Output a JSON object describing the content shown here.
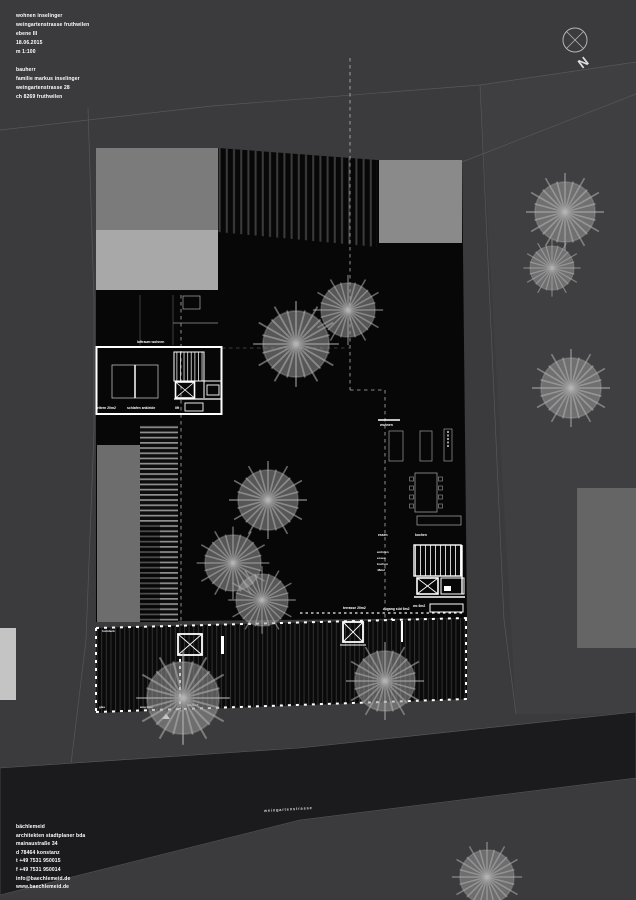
{
  "header": {
    "project_lines": [
      "wohnen inselinger",
      "weingartenstrasse fruthwilen",
      "ebene III",
      "18.06.2015",
      "m 1:100"
    ],
    "client_heading": "bauherr",
    "client_lines": [
      "familie markus inselinger",
      "weingartenstrasse 28",
      "ch 8269 fruthwilen"
    ]
  },
  "footer": {
    "firm_lines": [
      "bächlemeid",
      "architekten stadtplaner bda",
      "mainaustraße 34",
      "d 78464 konstanz",
      "t +49 7531 950015",
      "f +49 7531 950014",
      "info@baechlemeid.de",
      "www.baechlemeid.de"
    ]
  },
  "compass": {
    "label": "N"
  },
  "plan": {
    "street": "weingartenstrasse",
    "labels": {
      "luftraum": "luftraum wohnen",
      "eltern": "eltern 20m2",
      "ankleide": "schlafen ankleide",
      "lift": "lift",
      "wohnen": "wohnen",
      "essen": "essen",
      "kochen": "kochen",
      "stack": [
        "wohnen",
        "essen",
        "kochen",
        "48m2"
      ],
      "terrasse": "terrasse 20m2",
      "zugang": "zugang süd 6m2",
      "wc": "wc 6m2",
      "deck": "holzdeck",
      "glas": "glas",
      "weg": "weg folie",
      "lichthof": "lichthof"
    },
    "notes": [
      "ebene 3",
      "gesamt nfl ohne terrassen/lichtgarten",
      "grundstücksfläche 746m2 / bgf 170m2"
    ]
  },
  "colors": {
    "background": "#3b3b3d",
    "building": "#070707",
    "road": "#1b1b1d",
    "tree": "#999999",
    "text": "#ffffff"
  }
}
